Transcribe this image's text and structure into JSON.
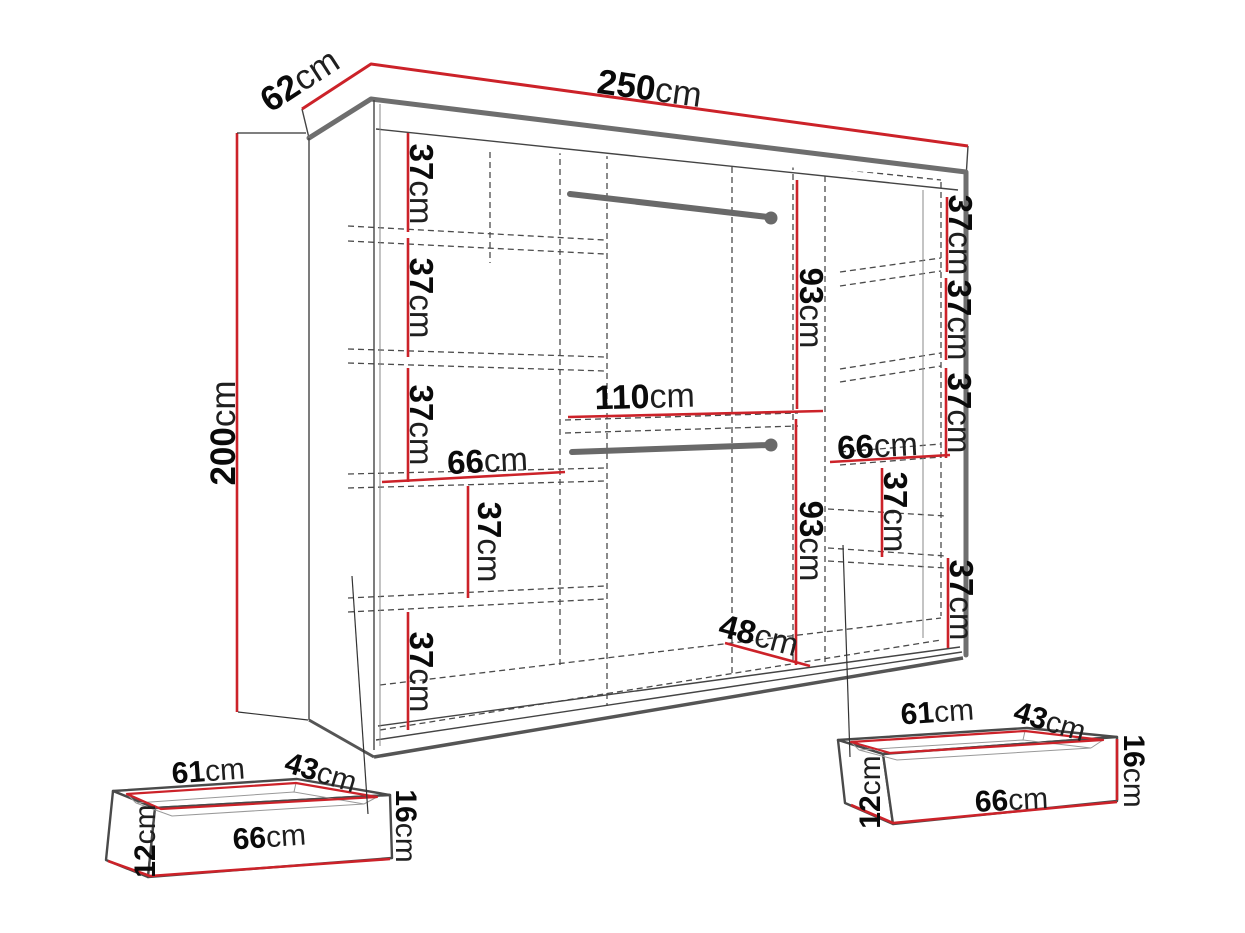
{
  "diagram": {
    "title": "Wardrobe dimension diagram",
    "subject": "Sliding-door wardrobe with shelves, two hanging rails and two drawers",
    "background": "#ffffff",
    "accent_red": "#cc2229",
    "line_gray": "#6a6a6a",
    "text_color": "#111111"
  },
  "wardrobe": {
    "width": {
      "value": "250",
      "unit": "cm"
    },
    "depth": {
      "value": "62",
      "unit": "cm"
    },
    "height": {
      "value": "200",
      "unit": "cm"
    }
  },
  "left_column": {
    "bay1": {
      "value": "37",
      "unit": "cm"
    },
    "bay2": {
      "value": "37",
      "unit": "cm"
    },
    "bay3": {
      "value": "37",
      "unit": "cm"
    },
    "shelf_width": {
      "value": "66",
      "unit": "cm"
    },
    "bay4": {
      "value": "37",
      "unit": "cm"
    },
    "bay5": {
      "value": "37",
      "unit": "cm"
    }
  },
  "center_section": {
    "upper_hanging": {
      "value": "93",
      "unit": "cm"
    },
    "width": {
      "value": "110",
      "unit": "cm"
    },
    "lower_hanging": {
      "value": "93",
      "unit": "cm"
    },
    "bottom_depth": {
      "value": "48",
      "unit": "cm"
    }
  },
  "right_column": {
    "bay1": {
      "value": "37",
      "unit": "cm"
    },
    "bay2": {
      "value": "37",
      "unit": "cm"
    },
    "bay3": {
      "value": "37",
      "unit": "cm"
    },
    "shelf_width": {
      "value": "66",
      "unit": "cm"
    },
    "bay4": {
      "value": "37",
      "unit": "cm"
    },
    "bay5": {
      "value": "37",
      "unit": "cm"
    }
  },
  "drawer_left": {
    "width": {
      "value": "61",
      "unit": "cm"
    },
    "depth": {
      "value": "43",
      "unit": "cm"
    },
    "height": {
      "value": "16",
      "unit": "cm"
    },
    "front_width": {
      "value": "66",
      "unit": "cm"
    },
    "inner_height": {
      "value": "12",
      "unit": "cm"
    }
  },
  "drawer_right": {
    "width": {
      "value": "61",
      "unit": "cm"
    },
    "depth": {
      "value": "43",
      "unit": "cm"
    },
    "height": {
      "value": "16",
      "unit": "cm"
    },
    "front_width": {
      "value": "66",
      "unit": "cm"
    },
    "inner_height": {
      "value": "12",
      "unit": "cm"
    }
  }
}
